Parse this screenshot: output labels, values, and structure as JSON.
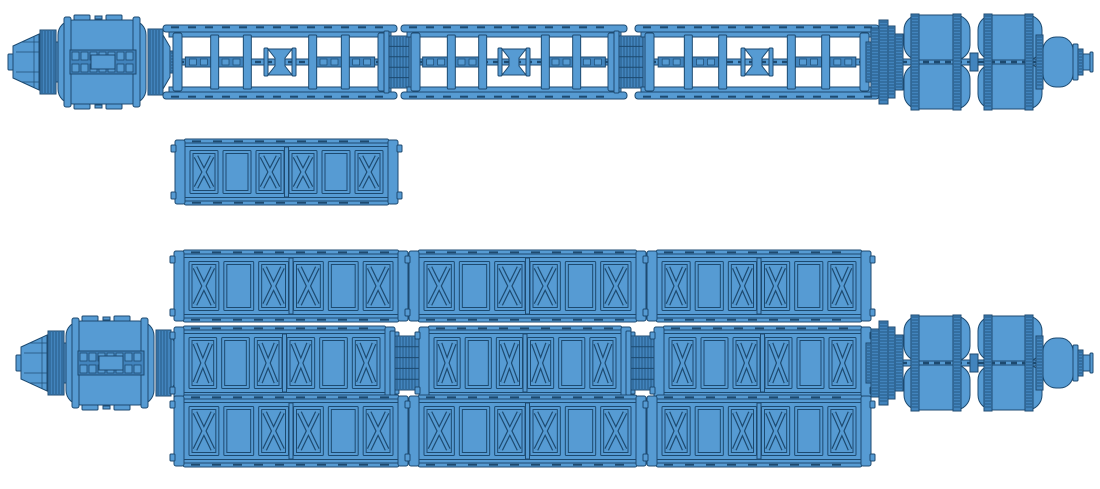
{
  "canvas": {
    "width": 1100,
    "height": 489,
    "background": "#ffffff"
  },
  "colors": {
    "fill": "#569bd3",
    "fill_dark": "#4284bd",
    "stroke": "#1d4a70",
    "background": "#ffffff"
  },
  "panel_pattern": [
    "x",
    "plain",
    "x",
    "x",
    "plain",
    "x"
  ],
  "assemblies": [
    {
      "id": "ship-a",
      "label": "open-truss-spacecraft"
    },
    {
      "id": "spare",
      "label": "spare-truss-segment"
    },
    {
      "id": "ship-b",
      "label": "triple-truss-spacecraft"
    }
  ],
  "parts": [
    {
      "name": "habitat-module",
      "assembly": "ship-a",
      "type": "module",
      "x": 8,
      "cy": 62
    },
    {
      "name": "open-truss-segment-1",
      "assembly": "ship-a",
      "type": "open_truss",
      "x": 173,
      "w": 214,
      "cy": 62
    },
    {
      "name": "truss-coupler-1",
      "assembly": "ship-a",
      "type": "accordion",
      "x": 388,
      "w": 22,
      "cy": 62,
      "h": 52
    },
    {
      "name": "open-truss-segment-2",
      "assembly": "ship-a",
      "type": "open_truss",
      "x": 411,
      "w": 206,
      "cy": 62
    },
    {
      "name": "truss-coupler-2",
      "assembly": "ship-a",
      "type": "accordion",
      "x": 618,
      "w": 26,
      "cy": 62,
      "h": 52
    },
    {
      "name": "open-truss-segment-3",
      "assembly": "ship-a",
      "type": "open_truss",
      "x": 645,
      "w": 224,
      "cy": 62
    },
    {
      "name": "tank-engine-cluster",
      "assembly": "ship-a",
      "type": "tanks",
      "x": 866,
      "cy": 62
    },
    {
      "name": "spare-panel-truss",
      "assembly": "spare",
      "type": "panel_truss",
      "x": 178,
      "w": 217,
      "cy": 172,
      "h": 58
    },
    {
      "name": "panel-truss-top-1",
      "assembly": "ship-b",
      "type": "panel_truss",
      "x": 177,
      "w": 228,
      "cy": 286,
      "h": 64
    },
    {
      "name": "panel-truss-top-2",
      "assembly": "ship-b",
      "type": "panel_truss",
      "x": 412,
      "w": 231,
      "cy": 286,
      "h": 64
    },
    {
      "name": "panel-truss-top-3",
      "assembly": "ship-b",
      "type": "panel_truss",
      "x": 650,
      "w": 218,
      "cy": 286,
      "h": 64
    },
    {
      "name": "habitat-module",
      "assembly": "ship-b",
      "type": "module",
      "x": 16,
      "cy": 363
    },
    {
      "name": "panel-truss-mid-1",
      "assembly": "ship-b",
      "type": "panel_truss",
      "x": 177,
      "w": 215,
      "cy": 363,
      "h": 66
    },
    {
      "name": "truss-coupler-1",
      "assembly": "ship-b",
      "type": "accordion",
      "x": 394,
      "w": 26,
      "cy": 363,
      "h": 54
    },
    {
      "name": "panel-truss-mid-2",
      "assembly": "ship-b",
      "type": "panel_truss",
      "x": 422,
      "w": 206,
      "cy": 363,
      "h": 66
    },
    {
      "name": "truss-coupler-2",
      "assembly": "ship-b",
      "type": "accordion",
      "x": 630,
      "w": 25,
      "cy": 363,
      "h": 54
    },
    {
      "name": "panel-truss-mid-3",
      "assembly": "ship-b",
      "type": "panel_truss",
      "x": 657,
      "w": 211,
      "cy": 363,
      "h": 66
    },
    {
      "name": "tank-engine-cluster",
      "assembly": "ship-b",
      "type": "tanks",
      "x": 866,
      "cy": 363
    },
    {
      "name": "panel-truss-bottom-1",
      "assembly": "ship-b",
      "type": "panel_truss",
      "x": 177,
      "w": 228,
      "cy": 431,
      "h": 64
    },
    {
      "name": "panel-truss-bottom-2",
      "assembly": "ship-b",
      "type": "panel_truss",
      "x": 412,
      "w": 231,
      "cy": 431,
      "h": 64
    },
    {
      "name": "panel-truss-bottom-3",
      "assembly": "ship-b",
      "type": "panel_truss",
      "x": 650,
      "w": 218,
      "cy": 431,
      "h": 64
    }
  ]
}
